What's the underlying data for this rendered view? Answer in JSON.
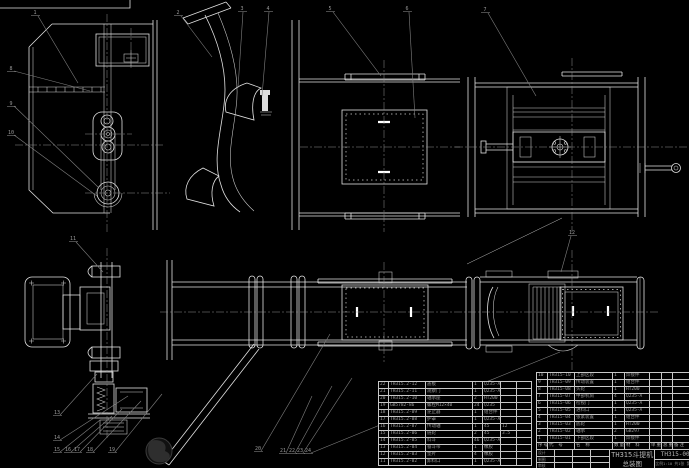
{
  "drawing": {
    "title": "TH315斗提机",
    "sheet_name": "总装图",
    "drawing_no": "TH315-00",
    "title_note": "比例1:10 共1张 第1张",
    "sig_labels": [
      "设计",
      "制图",
      "审核",
      "批准"
    ]
  },
  "bom": {
    "headers": [
      "序号",
      "代 号",
      "名 称",
      "数量",
      "材 料",
      "单重",
      "总重",
      "备注"
    ],
    "left_col_widths": [
      10,
      37,
      47,
      10,
      18,
      16,
      15
    ],
    "right_col_widths": [
      11,
      27,
      38,
      12,
      25,
      12,
      11,
      17
    ],
    "left_rows": [
      [
        "22",
        "TH315.2-12",
        "盖板",
        "1",
        "Q235-A",
        "",
        ""
      ],
      [
        "21",
        "TH315.2-11",
        "观察门",
        "1",
        "Q235-A",
        "",
        ""
      ],
      [
        "20",
        "TH315.2-10",
        "轴承座",
        "2",
        "HT200",
        "",
        ""
      ],
      [
        "19",
        "GB5782-86",
        "螺栓M12×40",
        "24",
        "Q235",
        "",
        ""
      ],
      [
        "18",
        "TH315.2-09",
        "逆止器",
        "1",
        "组合件",
        "",
        ""
      ],
      [
        "17",
        "TH315.2-08",
        "护罩",
        "1",
        "Q235-A",
        "",
        ""
      ],
      [
        "16",
        "TH315.2-07",
        "传动轴",
        "1",
        "45",
        "12",
        ""
      ],
      [
        "15",
        "TH315.2-06",
        "链轮",
        "2",
        "45",
        "3.5",
        ""
      ],
      [
        "14",
        "TH315.2-05",
        "料斗",
        "46",
        "Q235-A",
        "",
        ""
      ],
      [
        "13",
        "TH315.2-04",
        "畚斗带",
        "1",
        "橡胶",
        "",
        ""
      ],
      [
        "12",
        "TH315.2-03",
        "垫片",
        "4",
        "橡胶",
        "",
        ""
      ],
      [
        "11",
        "TH315.2-02",
        "卸料口",
        "1",
        "Q235-A",
        "",
        ""
      ]
    ],
    "right_rows": [
      [
        "10",
        "TH315-10",
        "上部区段",
        "1",
        "焊接件",
        "",
        "",
        ""
      ],
      [
        "9",
        "TH315-09",
        "传动装置",
        "1",
        "组合件",
        "",
        "",
        ""
      ],
      [
        "8",
        "TH315-08",
        "头轮",
        "1",
        "HT200",
        "",
        "",
        ""
      ],
      [
        "7",
        "TH315-07",
        "中部机筒",
        "4",
        "Q235-A",
        "",
        "",
        ""
      ],
      [
        "6",
        "TH315-06",
        "检视门",
        "1",
        "Q235-A",
        "",
        "",
        ""
      ],
      [
        "5",
        "TH315-05",
        "进料口",
        "1",
        "Q235-A",
        "",
        "",
        ""
      ],
      [
        "4",
        "TH315-04",
        "张紧装置",
        "1",
        "组合件",
        "",
        "",
        ""
      ],
      [
        "3",
        "TH315-03",
        "底轮",
        "1",
        "HT200",
        "",
        "",
        ""
      ],
      [
        "2",
        "TH315-02",
        "轴承",
        "2",
        "GB297",
        "",
        "",
        ""
      ],
      [
        "1",
        "TH315-01",
        "下部区段",
        "1",
        "焊接件",
        "",
        "",
        ""
      ]
    ]
  },
  "callouts": {
    "balloons": [
      {
        "n": "1",
        "x": 35,
        "y": 12
      },
      {
        "n": "2",
        "x": 178,
        "y": 12
      },
      {
        "n": "3",
        "x": 242,
        "y": 8
      },
      {
        "n": "4",
        "x": 268,
        "y": 8
      },
      {
        "n": "5",
        "x": 330,
        "y": 8
      },
      {
        "n": "6",
        "x": 407,
        "y": 8
      },
      {
        "n": "7",
        "x": 485,
        "y": 9
      },
      {
        "n": "8",
        "x": 11,
        "y": 68
      },
      {
        "n": "9",
        "x": 11,
        "y": 103
      },
      {
        "n": "10",
        "x": 11,
        "y": 132
      },
      {
        "n": "11",
        "x": 73,
        "y": 238
      },
      {
        "n": "12",
        "x": 572,
        "y": 232
      },
      {
        "n": "13",
        "x": 57,
        "y": 412
      },
      {
        "n": "14",
        "x": 57,
        "y": 437
      },
      {
        "n": "15",
        "x": 57,
        "y": 449
      },
      {
        "n": "16",
        "x": 68,
        "y": 449
      },
      {
        "n": "17",
        "x": 77,
        "y": 449
      },
      {
        "n": "18",
        "x": 90,
        "y": 449
      },
      {
        "n": "19",
        "x": 112,
        "y": 449
      },
      {
        "n": "20",
        "x": 258,
        "y": 448
      },
      {
        "n": "21",
        "x": 283,
        "y": 450
      },
      {
        "n": "22",
        "x": 292,
        "y": 450
      },
      {
        "n": "23",
        "x": 300,
        "y": 450
      },
      {
        "n": "24",
        "x": 308,
        "y": 450
      }
    ],
    "leaders": [
      [
        38,
        16,
        78,
        83
      ],
      [
        181,
        16,
        212,
        57
      ],
      [
        243,
        12,
        238,
        88
      ],
      [
        269,
        12,
        262,
        96
      ],
      [
        333,
        12,
        381,
        76
      ],
      [
        409,
        12,
        415,
        118
      ],
      [
        488,
        13,
        536,
        96
      ],
      [
        14,
        71,
        90,
        91
      ],
      [
        14,
        106,
        99,
        188
      ],
      [
        14,
        135,
        97,
        196
      ],
      [
        76,
        242,
        103,
        272
      ],
      [
        571,
        236,
        561,
        272
      ],
      [
        60,
        415,
        97,
        374
      ],
      [
        60,
        440,
        128,
        396
      ],
      [
        60,
        452,
        100,
        420
      ],
      [
        71,
        452,
        112,
        416
      ],
      [
        80,
        452,
        122,
        409
      ],
      [
        93,
        452,
        141,
        401
      ],
      [
        115,
        452,
        162,
        394
      ],
      [
        261,
        451,
        330,
        334
      ],
      [
        286,
        453,
        312,
        396
      ],
      [
        295,
        453,
        332,
        386
      ],
      [
        303,
        453,
        352,
        378
      ],
      [
        311,
        453,
        560,
        352
      ]
    ]
  }
}
